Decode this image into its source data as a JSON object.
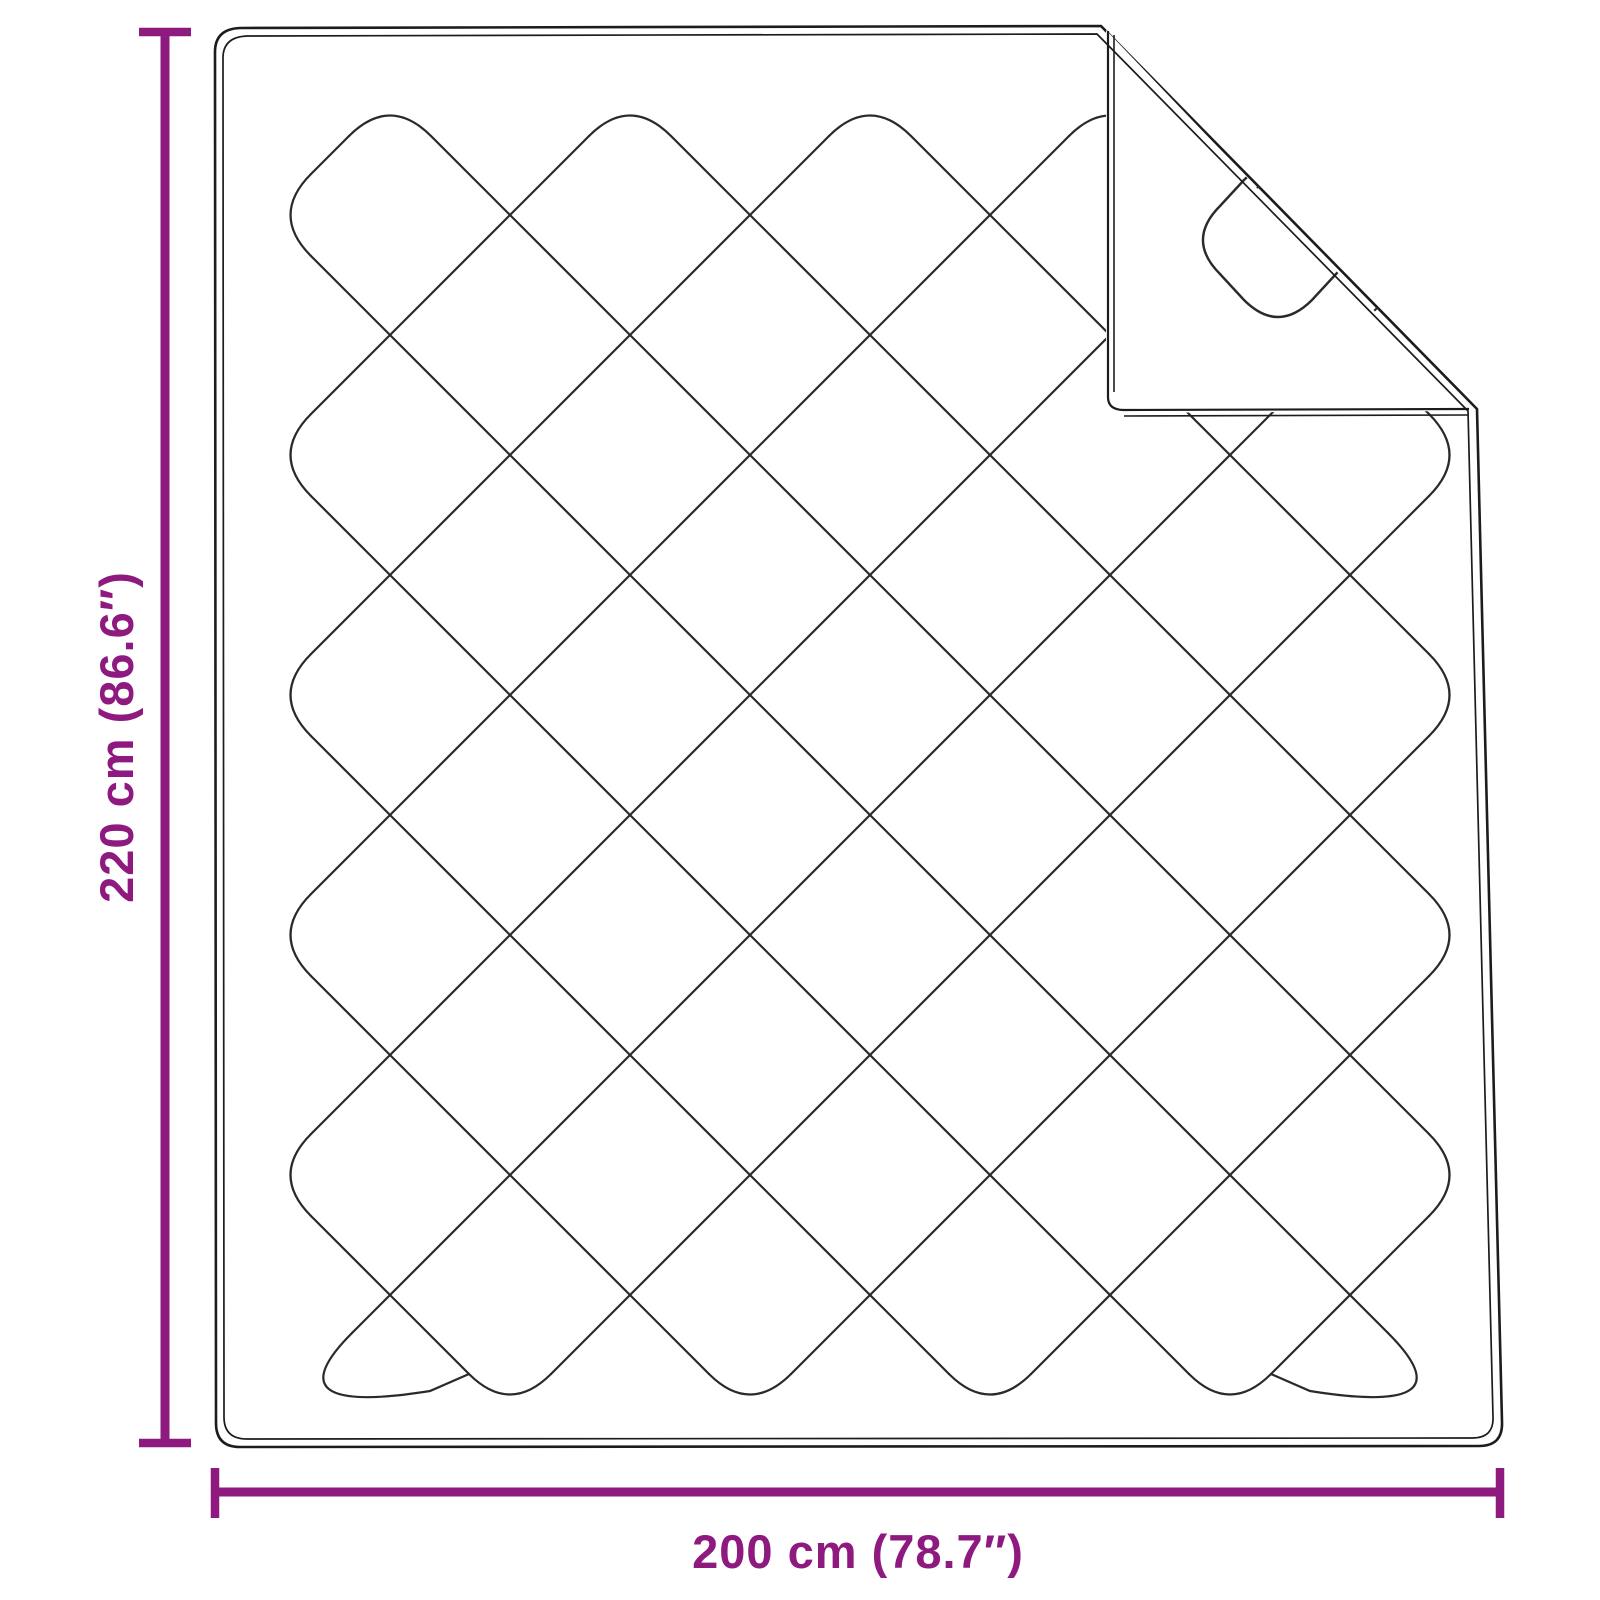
{
  "title": "Quilted blanket dimension diagram",
  "background_color": "#ffffff",
  "accent_color": "#8E1A80",
  "outline_color": "#1c1c1c",
  "pattern_color": "#2a2a2a",
  "dimensions": {
    "height": {
      "label": "220 cm (86.6″)"
    },
    "width": {
      "label": "200 cm (78.7″)"
    }
  }
}
